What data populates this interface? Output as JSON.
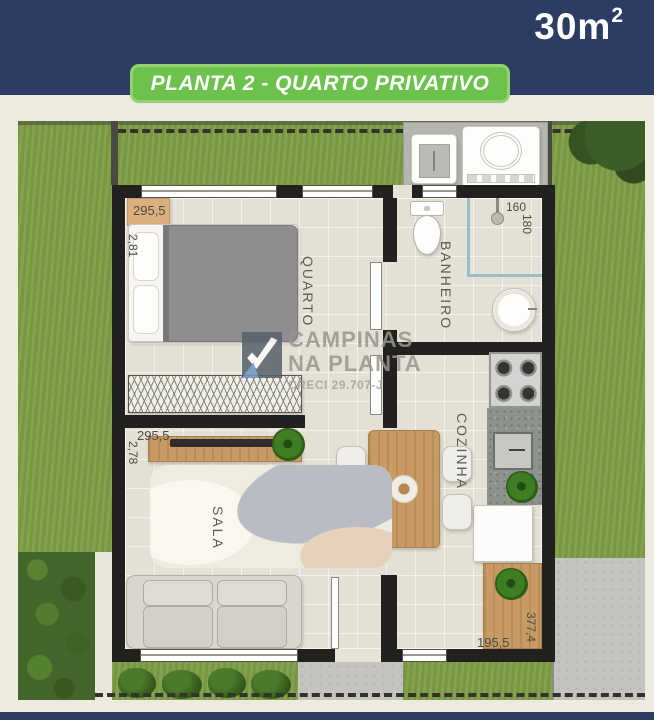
{
  "header": {
    "area_value": "30m",
    "area_exponent": "2",
    "banner_label": "PLANTA 2 - QUARTO PRIVATIVO"
  },
  "plan": {
    "rooms": {
      "bedroom_label": "QUARTO",
      "bathroom_label": "BANHEIRO",
      "kitchen_label": "COZINHA",
      "living_label": "SALA"
    },
    "dimensions": {
      "bedroom_width": "295,5",
      "bedroom_depth": "2,81",
      "bathroom_width": "160",
      "bathroom_depth": "180",
      "living_width": "295,5",
      "living_depth": "2,78",
      "kitchen_width": "195,5",
      "kitchen_depth": "377,4"
    },
    "watermark": {
      "brand_line1": "CAMPINAS",
      "brand_line2": "NA PLANTA",
      "license": "CRECI 29.707-J"
    }
  },
  "colors": {
    "navy": "#2d3c63",
    "banner_green": "#6cc24d",
    "grass_green": "#7d9c44",
    "wall_black": "#22211f",
    "wood_tan": "#c79b63"
  }
}
